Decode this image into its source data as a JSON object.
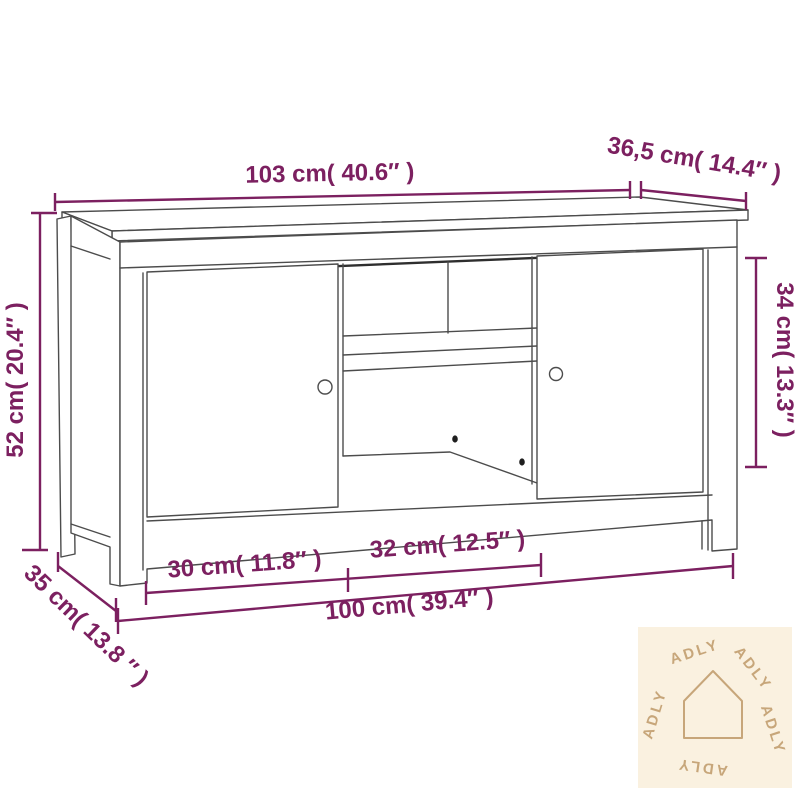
{
  "diagram": {
    "dimensions": {
      "top_width": {
        "cm": "103",
        "inch": "40.6",
        "label": "103 cm( 40.6″ )"
      },
      "top_depth": {
        "cm": "36,5",
        "inch": "14.4",
        "label": "36,5 cm( 14.4″ )"
      },
      "height": {
        "cm": "52",
        "inch": "20.4",
        "label": "52 cm( 20.4″ )"
      },
      "right_inner_height": {
        "cm": "34",
        "inch": "13.3",
        "label": "34 cm( 13.3″ )"
      },
      "base_depth": {
        "cm": "35",
        "inch": "13.8",
        "label": "35 cm( 13.8 ″ )"
      },
      "left_door_width": {
        "cm": "30",
        "inch": "11.8",
        "label": "30 cm( 11.8″ )"
      },
      "center_width": {
        "cm": "32",
        "inch": "12.5",
        "label": "32 cm( 12.5″ )"
      },
      "base_width": {
        "cm": "100",
        "inch": "39.4",
        "label": "100 cm( 39.4″ )"
      }
    },
    "colors": {
      "dimension": "#7c2060",
      "furniture_line": "#4c4c4c",
      "logo_background": "#faf1e0",
      "logo_foreground": "#c7a67a"
    }
  },
  "logo": {
    "brand": "ADLY"
  }
}
